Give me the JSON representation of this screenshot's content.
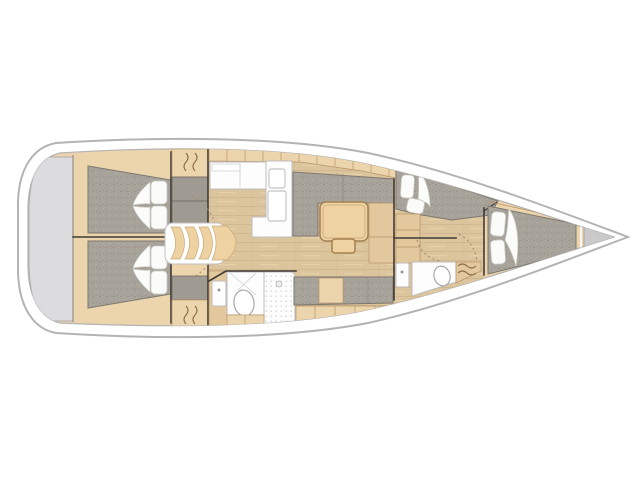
{
  "page": {
    "background": "#ffffff",
    "title": "Sailing yacht interior layout — top-down floor plan, bow to the right"
  },
  "diagram": {
    "type": "yacht-floorplan",
    "view": "top-down",
    "orientation": "bow-right",
    "rooms": [
      {
        "id": "swim-platform",
        "label": "Stern transom / swim platform"
      },
      {
        "id": "aft-cabin-port",
        "label": "Aft double cabin with berth and pillows (upper)"
      },
      {
        "id": "aft-cabin-stbd",
        "label": "Aft double cabin with berth and pillows (lower)"
      },
      {
        "id": "companionway",
        "label": "Companionway entry steps"
      },
      {
        "id": "galley",
        "label": "Galley with L-shaped counter, sink and stove"
      },
      {
        "id": "aft-head",
        "label": "Aft head with toilet, washbasin and shower"
      },
      {
        "id": "saloon",
        "label": "Saloon with U-settee, table and port settee"
      },
      {
        "id": "side-berth",
        "label": "Starboard side berth with pillows"
      },
      {
        "id": "forward-head",
        "label": "Forward head with toilet and washbasin"
      },
      {
        "id": "forward-cabin",
        "label": "Forward V-berth owner cabin"
      },
      {
        "id": "anchor-locker",
        "label": "Bow anchor locker"
      }
    ],
    "counts": {
      "aft_cabins": 2,
      "forward_cabins": 1,
      "heads": 2,
      "saloon_tables": 1
    }
  },
  "colors": {
    "pageBg": "#ffffff",
    "hullFill": "#ffffff",
    "hullStroke": "#b3b3b3",
    "deckWood": "#ecd4ac",
    "midWood": "#e2c89c",
    "floorWood": "#dcc49c",
    "trimBrown": "#b89468",
    "mattress": "#a7a29a",
    "mattressEdge": "#7d7870",
    "cabinetGray": "#a09b92",
    "transom": "#dcdcde",
    "white": "#fdfdfd",
    "whiteEdge": "#bdbdbd",
    "wall": "#3f3b35",
    "tableWood": "#eed2a2",
    "tableEdge": "#a5814e",
    "dashes": "#9a8a6a",
    "bowLocker": "#c9c9ca"
  }
}
